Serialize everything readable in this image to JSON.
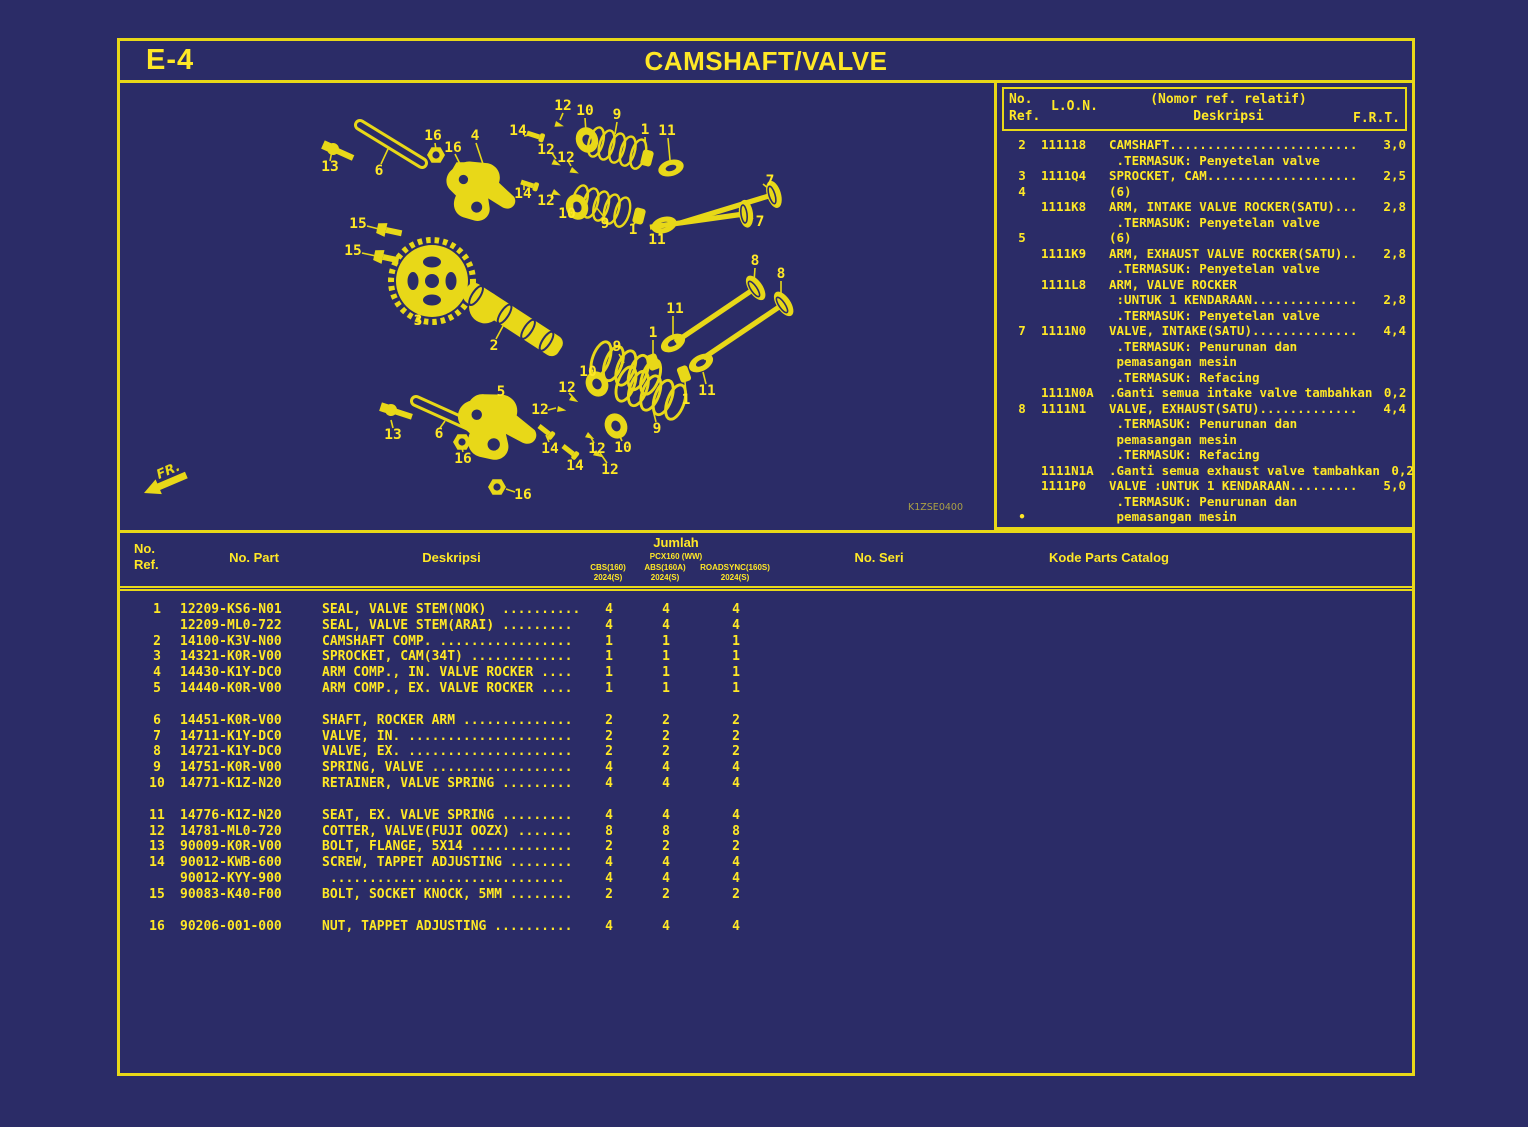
{
  "page": {
    "code": "E-4",
    "title": "CAMSHAFT/VALVE",
    "diagram_code": "K1ZSE0400",
    "fr_label": "FR."
  },
  "lon_panel": {
    "headers": {
      "ref1": "No.",
      "ref2": "Ref.",
      "lon": "L.O.N.",
      "relatif": "(Nomor ref. relatif)",
      "desc": "Deskripsi",
      "frt": "F.R.T."
    },
    "rows": [
      {
        "ref": "2",
        "lon": "111118",
        "desc": "CAMSHAFT.........................",
        "frt": "3,0"
      },
      {
        "desc": " .TERMASUK: Penyetelan valve"
      },
      {
        "ref": "3",
        "lon": "1111Q4",
        "desc": "SPROCKET, CAM....................",
        "frt": "2,5"
      },
      {
        "ref": "4",
        "desc": "(6)"
      },
      {
        "lon": "1111K8",
        "desc": "ARM, INTAKE VALVE ROCKER(SATU)...",
        "frt": "2,8"
      },
      {
        "desc": " .TERMASUK: Penyetelan valve"
      },
      {
        "ref": "5",
        "desc": "(6)"
      },
      {
        "lon": "1111K9",
        "desc": "ARM, EXHAUST VALVE ROCKER(SATU)..",
        "frt": "2,8"
      },
      {
        "desc": " .TERMASUK: Penyetelan valve"
      },
      {
        "lon": "1111L8",
        "desc": "ARM, VALVE ROCKER"
      },
      {
        "desc": " :UNTUK 1 KENDARAAN..............",
        "frt": "2,8"
      },
      {
        "desc": " .TERMASUK: Penyetelan valve"
      },
      {
        "ref": "7",
        "lon": "1111N0",
        "desc": "VALVE, INTAKE(SATU)..............",
        "frt": "4,4"
      },
      {
        "desc": " .TERMASUK: Penurunan dan"
      },
      {
        "desc": " pemasangan mesin"
      },
      {
        "desc": " .TERMASUK: Refacing"
      },
      {
        "lon": "1111N0A",
        "desc": ".Ganti semua intake valve tambahkan",
        "frt": "0,2"
      },
      {
        "ref": "8",
        "lon": "1111N1",
        "desc": "VALVE, EXHAUST(SATU).............",
        "frt": "4,4"
      },
      {
        "desc": " .TERMASUK: Penurunan dan"
      },
      {
        "desc": " pemasangan mesin"
      },
      {
        "desc": " .TERMASUK: Refacing"
      },
      {
        "lon": "1111N1A",
        "desc": ".Ganti semua exhaust valve tambahkan",
        "frt": "0,2"
      },
      {
        "lon": "1111P0",
        "desc": "VALVE :UNTUK 1 KENDARAAN.........",
        "frt": "5,0"
      },
      {
        "desc": " .TERMASUK: Penurunan dan"
      },
      {
        "ref": "•",
        "desc": " pemasangan mesin"
      }
    ]
  },
  "parts_table": {
    "headers": {
      "ref_line1": "No.",
      "ref_line2": "Ref.",
      "part": "No. Part",
      "desc": "Deskripsi",
      "jumlah": "Jumlah",
      "model": "PCX160 (WW)",
      "cols": [
        {
          "l1": "CBS(160)",
          "l2": "2024(S)"
        },
        {
          "l1": "ABS(160A)",
          "l2": "2024(S)"
        },
        {
          "l1": "ROADSYNC(160S)",
          "l2": "2024(S)"
        }
      ],
      "seri": "No. Seri",
      "kode": "Kode Parts Catalog"
    },
    "groups": [
      [
        {
          "ref": "1",
          "part": "12209-KS6-N01",
          "desc": "SEAL, VALVE STEM(NOK)  ..........",
          "q": [
            "4",
            "4",
            "4"
          ]
        },
        {
          "part": "12209-ML0-722",
          "desc": "SEAL, VALVE STEM(ARAI) .........",
          "q": [
            "4",
            "4",
            "4"
          ]
        },
        {
          "ref": "2",
          "part": "14100-K3V-N00",
          "desc": "CAMSHAFT COMP. .................",
          "q": [
            "1",
            "1",
            "1"
          ]
        },
        {
          "ref": "3",
          "part": "14321-K0R-V00",
          "desc": "SPROCKET, CAM(34T) .............",
          "q": [
            "1",
            "1",
            "1"
          ]
        },
        {
          "ref": "4",
          "part": "14430-K1Y-DC0",
          "desc": "ARM COMP., IN. VALVE ROCKER ....",
          "q": [
            "1",
            "1",
            "1"
          ]
        },
        {
          "ref": "5",
          "part": "14440-K0R-V00",
          "desc": "ARM COMP., EX. VALVE ROCKER ....",
          "q": [
            "1",
            "1",
            "1"
          ]
        }
      ],
      [
        {
          "ref": "6",
          "part": "14451-K0R-V00",
          "desc": "SHAFT, ROCKER ARM ..............",
          "q": [
            "2",
            "2",
            "2"
          ]
        },
        {
          "ref": "7",
          "part": "14711-K1Y-DC0",
          "desc": "VALVE, IN. .....................",
          "q": [
            "2",
            "2",
            "2"
          ]
        },
        {
          "ref": "8",
          "part": "14721-K1Y-DC0",
          "desc": "VALVE, EX. .....................",
          "q": [
            "2",
            "2",
            "2"
          ]
        },
        {
          "ref": "9",
          "part": "14751-K0R-V00",
          "desc": "SPRING, VALVE ..................",
          "q": [
            "4",
            "4",
            "4"
          ]
        },
        {
          "ref": "10",
          "part": "14771-K1Z-N20",
          "desc": "RETAINER, VALVE SPRING .........",
          "q": [
            "4",
            "4",
            "4"
          ]
        }
      ],
      [
        {
          "ref": "11",
          "part": "14776-K1Z-N20",
          "desc": "SEAT, EX. VALVE SPRING .........",
          "q": [
            "4",
            "4",
            "4"
          ]
        },
        {
          "ref": "12",
          "part": "14781-ML0-720",
          "desc": "COTTER, VALVE(FUJI OOZX) .......",
          "q": [
            "8",
            "8",
            "8"
          ]
        },
        {
          "ref": "13",
          "part": "90009-K0R-V00",
          "desc": "BOLT, FLANGE, 5X14 .............",
          "q": [
            "2",
            "2",
            "2"
          ]
        },
        {
          "ref": "14",
          "part": "90012-KWB-600",
          "desc": "SCREW, TAPPET ADJUSTING ........",
          "q": [
            "4",
            "4",
            "4"
          ]
        },
        {
          "part": "90012-KYY-900",
          "desc": " ..............................",
          "q": [
            "4",
            "4",
            "4"
          ]
        },
        {
          "ref": "15",
          "part": "90083-K40-F00",
          "desc": "BOLT, SOCKET KNOCK, 5MM ........",
          "q": [
            "2",
            "2",
            "2"
          ]
        }
      ],
      [
        {
          "ref": "16",
          "part": "90206-001-000",
          "desc": "NUT, TAPPET ADJUSTING ..........",
          "q": [
            "4",
            "4",
            "4"
          ]
        }
      ]
    ]
  },
  "callouts": [
    {
      "t": "12",
      "x": 443,
      "y": 23
    },
    {
      "t": "10",
      "x": 465,
      "y": 28
    },
    {
      "t": "9",
      "x": 497,
      "y": 32
    },
    {
      "t": "14",
      "x": 398,
      "y": 48
    },
    {
      "t": "1",
      "x": 525,
      "y": 47
    },
    {
      "t": "11",
      "x": 547,
      "y": 48
    },
    {
      "t": "13",
      "x": 210,
      "y": 84
    },
    {
      "t": "6",
      "x": 259,
      "y": 88
    },
    {
      "t": "16",
      "x": 313,
      "y": 53
    },
    {
      "t": "16",
      "x": 333,
      "y": 65
    },
    {
      "t": "4",
      "x": 355,
      "y": 53
    },
    {
      "t": "12",
      "x": 426,
      "y": 67
    },
    {
      "t": "12",
      "x": 446,
      "y": 75
    },
    {
      "t": "7",
      "x": 650,
      "y": 98
    },
    {
      "t": "14",
      "x": 403,
      "y": 111
    },
    {
      "t": "12",
      "x": 426,
      "y": 118
    },
    {
      "t": "10",
      "x": 447,
      "y": 131
    },
    {
      "t": "9",
      "x": 485,
      "y": 141
    },
    {
      "t": "1",
      "x": 513,
      "y": 147
    },
    {
      "t": "11",
      "x": 537,
      "y": 157
    },
    {
      "t": "7",
      "x": 640,
      "y": 139
    },
    {
      "t": "15",
      "x": 238,
      "y": 141
    },
    {
      "t": "15",
      "x": 233,
      "y": 168
    },
    {
      "t": "8",
      "x": 635,
      "y": 178
    },
    {
      "t": "8",
      "x": 661,
      "y": 191
    },
    {
      "t": "3",
      "x": 298,
      "y": 238
    },
    {
      "t": "11",
      "x": 555,
      "y": 226
    },
    {
      "t": "2",
      "x": 374,
      "y": 263
    },
    {
      "t": "1",
      "x": 533,
      "y": 250
    },
    {
      "t": "9",
      "x": 497,
      "y": 264
    },
    {
      "t": "10",
      "x": 468,
      "y": 289
    },
    {
      "t": "12",
      "x": 447,
      "y": 305
    },
    {
      "t": "12",
      "x": 420,
      "y": 327
    },
    {
      "t": "5",
      "x": 381,
      "y": 309
    },
    {
      "t": "13",
      "x": 273,
      "y": 352
    },
    {
      "t": "6",
      "x": 319,
      "y": 351
    },
    {
      "t": "14",
      "x": 430,
      "y": 366
    },
    {
      "t": "14",
      "x": 455,
      "y": 383
    },
    {
      "t": "12",
      "x": 477,
      "y": 366
    },
    {
      "t": "12",
      "x": 490,
      "y": 387
    },
    {
      "t": "10",
      "x": 503,
      "y": 365
    },
    {
      "t": "9",
      "x": 537,
      "y": 346
    },
    {
      "t": "1",
      "x": 566,
      "y": 317
    },
    {
      "t": "11",
      "x": 587,
      "y": 308
    },
    {
      "t": "16",
      "x": 343,
      "y": 376
    },
    {
      "t": "16",
      "x": 403,
      "y": 412
    }
  ]
}
